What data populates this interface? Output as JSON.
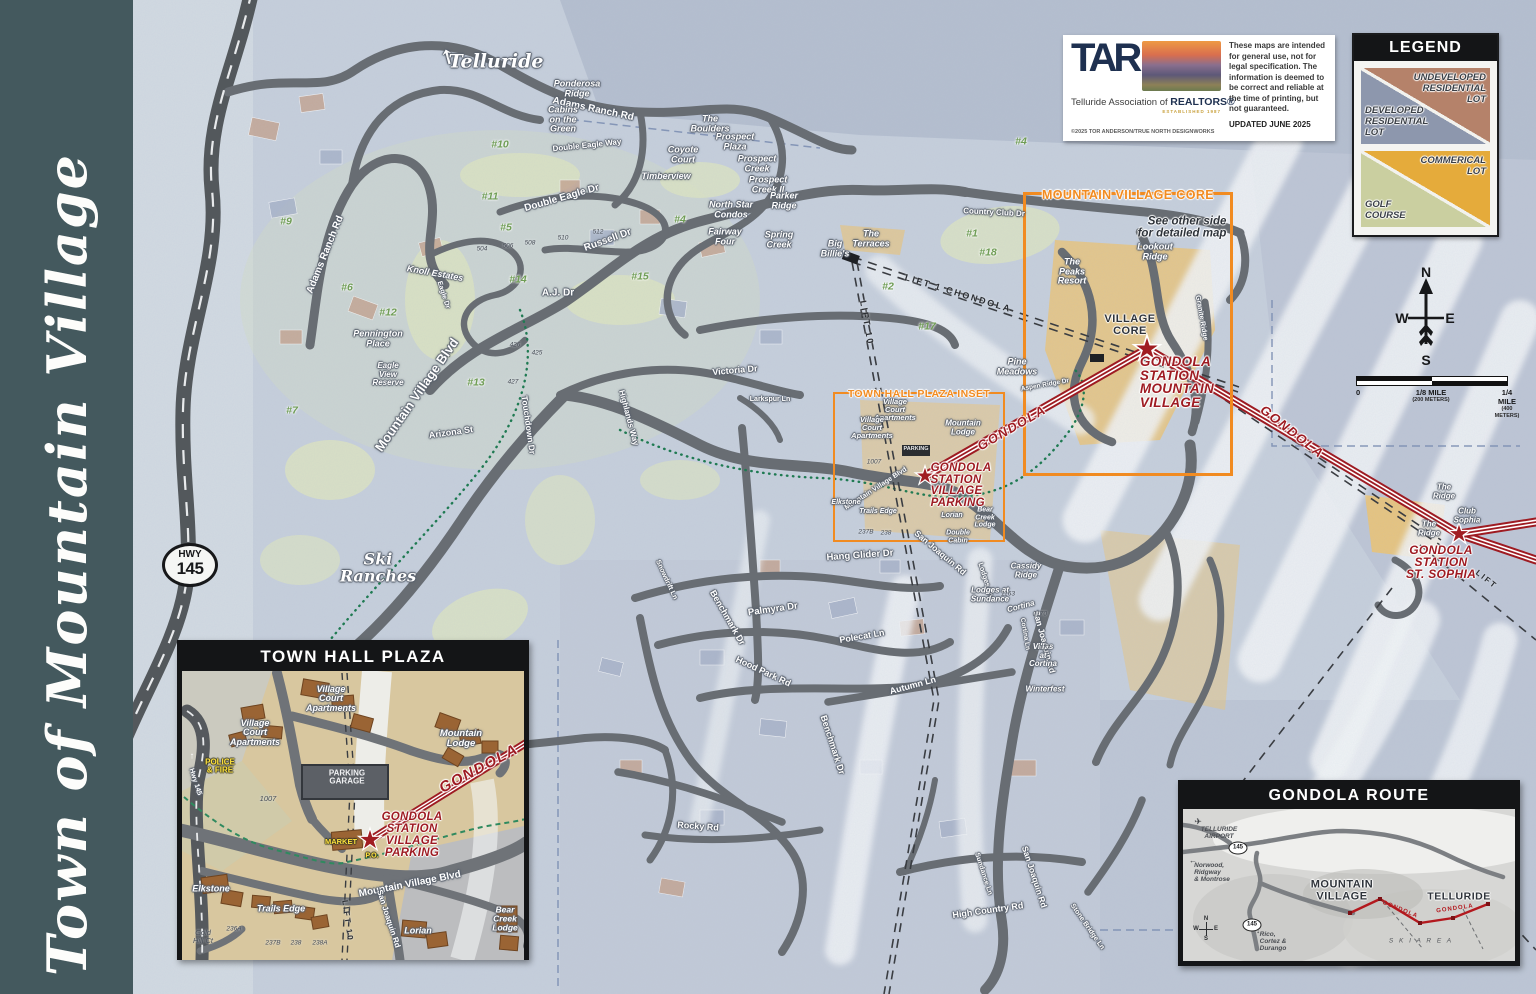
{
  "sidebar": {
    "title": "Town of Mountain Village"
  },
  "attribution": {
    "logo": "TAR",
    "org_prefix": "Telluride Association of ",
    "org_bold": "REALTORS®",
    "established": "ESTABLISHED 1987",
    "copyright": "©2025 TOR ANDERSON/TRUE NORTH DESIGNWORKS",
    "disclaimer": "These maps are intended for general use, not for legal specification. The information is deemed to be correct and reliable at the time of printing, but not guaranteed.",
    "updated": "UPDATED JUNE 2025"
  },
  "legend": {
    "title": "LEGEND",
    "undeveloped": "UNDEVELOPED\nRESIDENTIAL\nLOT",
    "developed": "DEVELOPED\nRESIDENTIAL\nLOT",
    "commercial": "COMMERICAL\nLOT",
    "golf": "GOLF\nCOURSE",
    "colors": {
      "undeveloped": "#b5826a",
      "developed": "#8d97ad",
      "commercial": "#e5ab3b",
      "golf": "#cacfa0"
    }
  },
  "compass": {
    "n": "N",
    "w": "W",
    "e": "E",
    "s": "S"
  },
  "scale": {
    "zero": "0",
    "eighth": "1/8 MILE",
    "eighth_m": "(200 METERS)",
    "quarter": "1/4 MILE",
    "quarter_m": "(400 METERS)"
  },
  "hwy_shield": {
    "line1": "HWY",
    "line2": "145"
  },
  "icons": {
    "up_arrow": "↑",
    "left_arrow": "←",
    "down_arrow": "↓",
    "plane": "✈"
  },
  "map": {
    "telluride": "Telluride",
    "ski_ranches": "Ski\nRanches",
    "core_box_title": "MOUNTAIN VILLAGE CORE",
    "core_box_note": "See other side\nfor detailed map",
    "inset_box_title": "TOWN HALL PLAZA INSET",
    "station_mv": "GONDOLA\nSTATION\nMOUNTAIN\nVILLAGE",
    "station_parking": "GONDOLA\nSTATION\nVILLAGE\nPARKING",
    "station_sophia": "GONDOLA\nSTATION\nST. SOPHIA",
    "gondola": "GONDOLA",
    "lift_chondola": "LIFT 1   CHONDOLA",
    "lift_10": "LIFT 10",
    "lift": "LIFT",
    "parking_bldg": "PARKING",
    "streets": {
      "mvblvd": "Mountain Village Blvd",
      "mvblvd2": "Mountain Village Blvd",
      "adams1": "Adams Ranch Rd",
      "adams2": "Adams Ranch Rd",
      "deagle": "Double Eagle Dr",
      "dway": "Double Eagle Way",
      "russell": "Russell Dr",
      "countryclub": "Country Club Dr",
      "aj": "A.J. Dr",
      "victoria": "Victoria Dr",
      "arizona": "Arizona St",
      "touchdown": "Touchdown Dr",
      "highlands": "Highlands Way",
      "eagle": "Eagle Dr",
      "larkspur": "Larkspur Ln",
      "hangglider": "Hang Glider Dr",
      "palmyra": "Palmyra Dr",
      "benchmark1": "Benchmark Dr",
      "benchmark2": "Benchmark Dr",
      "polecat": "Polecat Ln",
      "hoodpark": "Hood Park Rd",
      "autumn": "Autumn Ln",
      "sanjoaquin1": "San Joaquin Rd",
      "sanjoaquin2": "San Joaquin Rd",
      "sanjoaquin3": "San Joaquin Rd",
      "highcountry": "High Country Rd",
      "sundance": "Sundance Ln",
      "rocky": "Rocky Rd",
      "stonebridge": "Stone Bridge Ln",
      "snowdrift": "Snowdrift Ln",
      "lodges": "Lodges Ln",
      "cortina_ln": "Cortina Ln",
      "granite": "Granite Ridge",
      "aspen": "Aspen Ridge Dr"
    },
    "places": {
      "peaks": "The\nPeaks\nResort",
      "lookout": "Lookout\nRidge",
      "core": "VILLAGE\nCORE",
      "pine": "Pine\nMeadows",
      "terraces": "The\nTerraces",
      "bigb": "Big\nBillie's",
      "boulders": "The\nBoulders",
      "pplaza": "Prospect\nPlaza",
      "pcreek": "Prospect\nCreek",
      "pcreek2": "Prospect\nCreek II",
      "coyote": "Coyote\nCourt",
      "timber": "Timberview",
      "parker": "Parker\nRidge",
      "northstar": "North Star\nCondos",
      "fairway4": "Fairway\nFour",
      "springcreek": "Spring\nCreek",
      "ponderosa": "Ponderosa\nRidge",
      "cabins": "Cabins\non the\nGreen",
      "knoll": "Knoll Estates",
      "pennington": "Pennington\nPlace",
      "eagleview": "Eagle\nView\nReserve",
      "vca": "Village\nCourt\nApartments",
      "mlodge": "Mountain\nLodge",
      "lsundance": "Lodges at\nSundance",
      "cassidy": "Cassidy\nRidge",
      "cortina": "Cortina",
      "villas": "Villas\nat\nCortina",
      "ridge": "The\nRidge",
      "club": "Club\nSophia",
      "elkstone": "Elkstone",
      "trails": "Trails Edge",
      "lorian": "Lorian",
      "bear": "Bear\nCreek\nLodge",
      "dcabin": "Double\nCabin",
      "winterfest": "Winterfest"
    },
    "golf": {
      "h1": "#1",
      "h2": "#2",
      "h4": "#4",
      "h4b": "#4",
      "h5": "#5",
      "h6": "#6",
      "h7": "#7",
      "h9": "#9",
      "h10": "#10",
      "h11": "#11",
      "h12": "#12",
      "h13": "#13",
      "h14": "#14",
      "h15": "#15",
      "h17": "#17",
      "h18": "#18"
    },
    "lots": {
      "l504": "504",
      "l506": "506",
      "l508": "508",
      "l510": "510",
      "l512": "512",
      "l425": "425",
      "l426": "426",
      "l427": "427",
      "l1007": "1007",
      "l1163": "1163",
      "l1170": "1170",
      "l1177": "1177",
      "l237b": "237B",
      "l238": "238"
    }
  },
  "thp": {
    "title": "TOWN HALL PLAZA",
    "labels": {
      "vca": "Village\nCourt\nApartments",
      "mlodge": "Mountain\nLodge",
      "police": "POLICE\n& FIRE",
      "garage": "PARKING\nGARAGE",
      "market": "MARKET",
      "po": "P.O.",
      "station": "GONDOLA\nSTATION\nVILLAGE\nPARKING",
      "gondola": "GONDOLA",
      "blvd": "Mountain Village Blvd",
      "sanjoaquin": "San Joaquin Rd",
      "lift10": "LIFT 10",
      "hwy": "Hwy 145",
      "elkstone": "Elkstone",
      "trails": "Trails Edge",
      "lorian": "Lorian",
      "bear": "Bear\nCreek\nLodge",
      "goldhill": "Gold\nHill Ct",
      "l1007": "1007",
      "l236a": "236A",
      "l237b": "237B",
      "l238": "238",
      "l238a": "238A"
    }
  },
  "route": {
    "title": "GONDOLA ROUTE",
    "labels": {
      "airport": "TELLURIDE\nAIRPORT",
      "shield": "145",
      "norwood": "Norwood,\nRidgway\n& Montrose",
      "mv": "MOUNTAIN\nVILLAGE",
      "telluride": "TELLURIDE",
      "gondola": "GONDOLA",
      "ski": "S K I   A R E A",
      "rico": "Rico,\nCortez &\nDurango"
    },
    "compass": {
      "n": "N",
      "w": "W",
      "e": "E",
      "s": "S"
    }
  }
}
